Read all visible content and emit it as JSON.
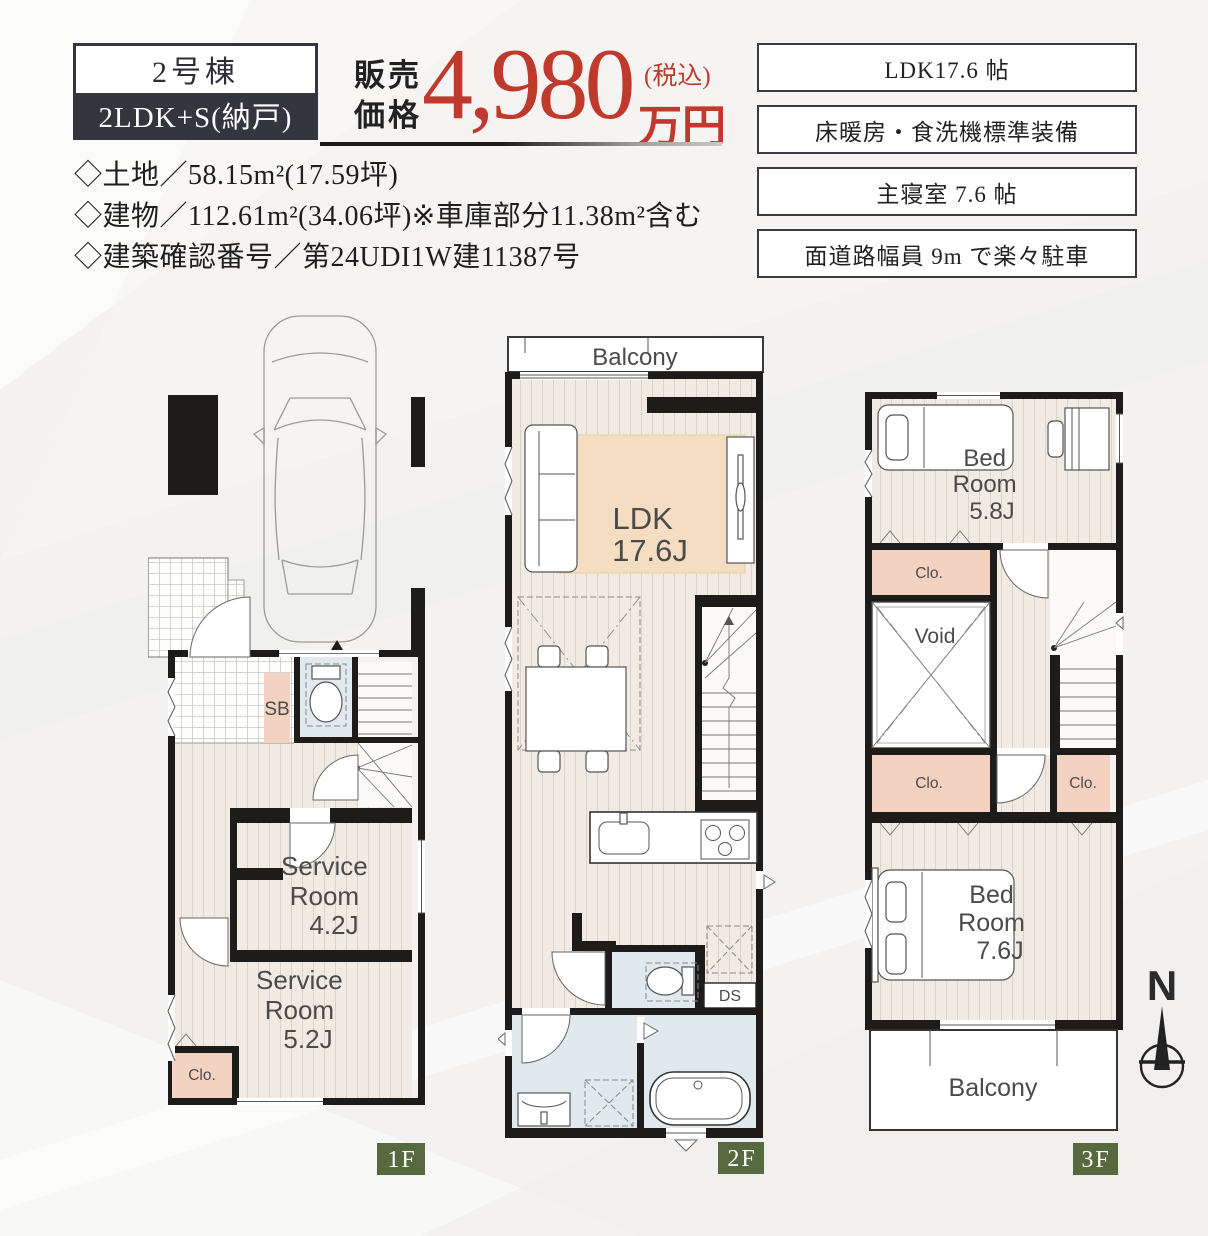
{
  "colors": {
    "accent_red": "#bf392c",
    "dark_navy": "#35353f",
    "wall_black": "#1d1c1a",
    "wood_floor": "#f1ebe3",
    "rug_beige": "#f4ddc0",
    "closet_salmon": "#f4d2c1",
    "wet_area_blue": "#dfe9ee",
    "floor_badge_green": "#57693e",
    "background": "#f3f2f1"
  },
  "header": {
    "badge": {
      "building": "2号棟",
      "layout": "2LDK+S(納戸)"
    },
    "price": {
      "label_line1": "販売",
      "label_line2": "価格",
      "amount": "4,980",
      "tax_note": "(税込)",
      "unit": "万円"
    },
    "details": [
      "◇土地／58.15m²(17.59坪)",
      "◇建物／112.61m²(34.06坪)※車庫部分11.38m²含む",
      "◇建築確認番号／第24UDI1W建11387号"
    ],
    "features": [
      "LDK17.6 帖",
      "床暖房・食洗機標準装備",
      "主寝室 7.6 帖",
      "面道路幅員 9m で楽々駐車"
    ]
  },
  "floors": {
    "f1": {
      "badge": "1F",
      "rooms": {
        "shoe_box": "SB",
        "service_room_a": [
          "Service",
          "Room",
          "4.2J"
        ],
        "service_room_b": [
          "Service",
          "Room",
          "5.2J"
        ],
        "closet": "Clo."
      }
    },
    "f2": {
      "badge": "2F",
      "rooms": {
        "balcony": "Balcony",
        "ldk_line1": "LDK",
        "ldk_line2": "17.6J",
        "duct_space": "DS"
      }
    },
    "f3": {
      "badge": "3F",
      "rooms": {
        "bedroom_a": [
          "Bed",
          "Room",
          "5.8J"
        ],
        "closet_a": "Clo.",
        "void": "Void",
        "closet_b": "Clo.",
        "closet_c": "Clo.",
        "bedroom_b": [
          "Bed",
          "Room",
          "7.6J"
        ],
        "balcony": "Balcony"
      }
    }
  },
  "compass": {
    "north": "N"
  }
}
